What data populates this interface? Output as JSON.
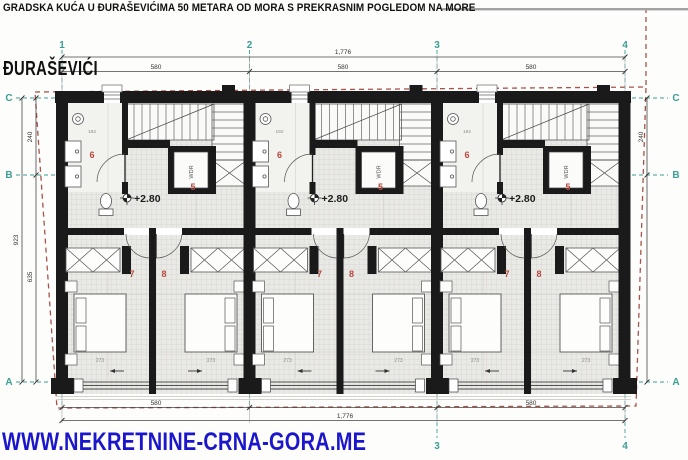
{
  "header": {
    "title": "GRADSKA KUĆA U ĐURAŠEVIĆIMA 50 METARA OD MORA S PREKRASNIM POGLEDOM NA MORE",
    "location": "ĐURAŠEVIĆI",
    "website": "WWW.NEKRETNINE-CRNA-GORA.ME"
  },
  "grid": {
    "columns": [
      "1",
      "2",
      "3",
      "4"
    ],
    "rows": [
      "C",
      "B",
      "A"
    ]
  },
  "dims": {
    "overall_width": "1,776",
    "bay_widths": [
      "580",
      "580",
      "580"
    ],
    "bottom_bays": [
      "580",
      "580"
    ],
    "overall_height": "923",
    "row_c_b": "240",
    "row_b_a": "635"
  },
  "unit": {
    "hall_number": "5",
    "bath_number": "6",
    "bedroom_left_number": "7",
    "bedroom_right_number": "8",
    "level": "+2.80",
    "wardrobe_label": "WDR",
    "bed_zone_dim": "273",
    "bath_dim": "192"
  },
  "colors": {
    "grid_teal": "#3a9e92",
    "boundary_red": "#a8524c",
    "room_number_red": "#b8473e",
    "wall_black": "#1a1a1a",
    "website_blue": "#1b16cc"
  }
}
